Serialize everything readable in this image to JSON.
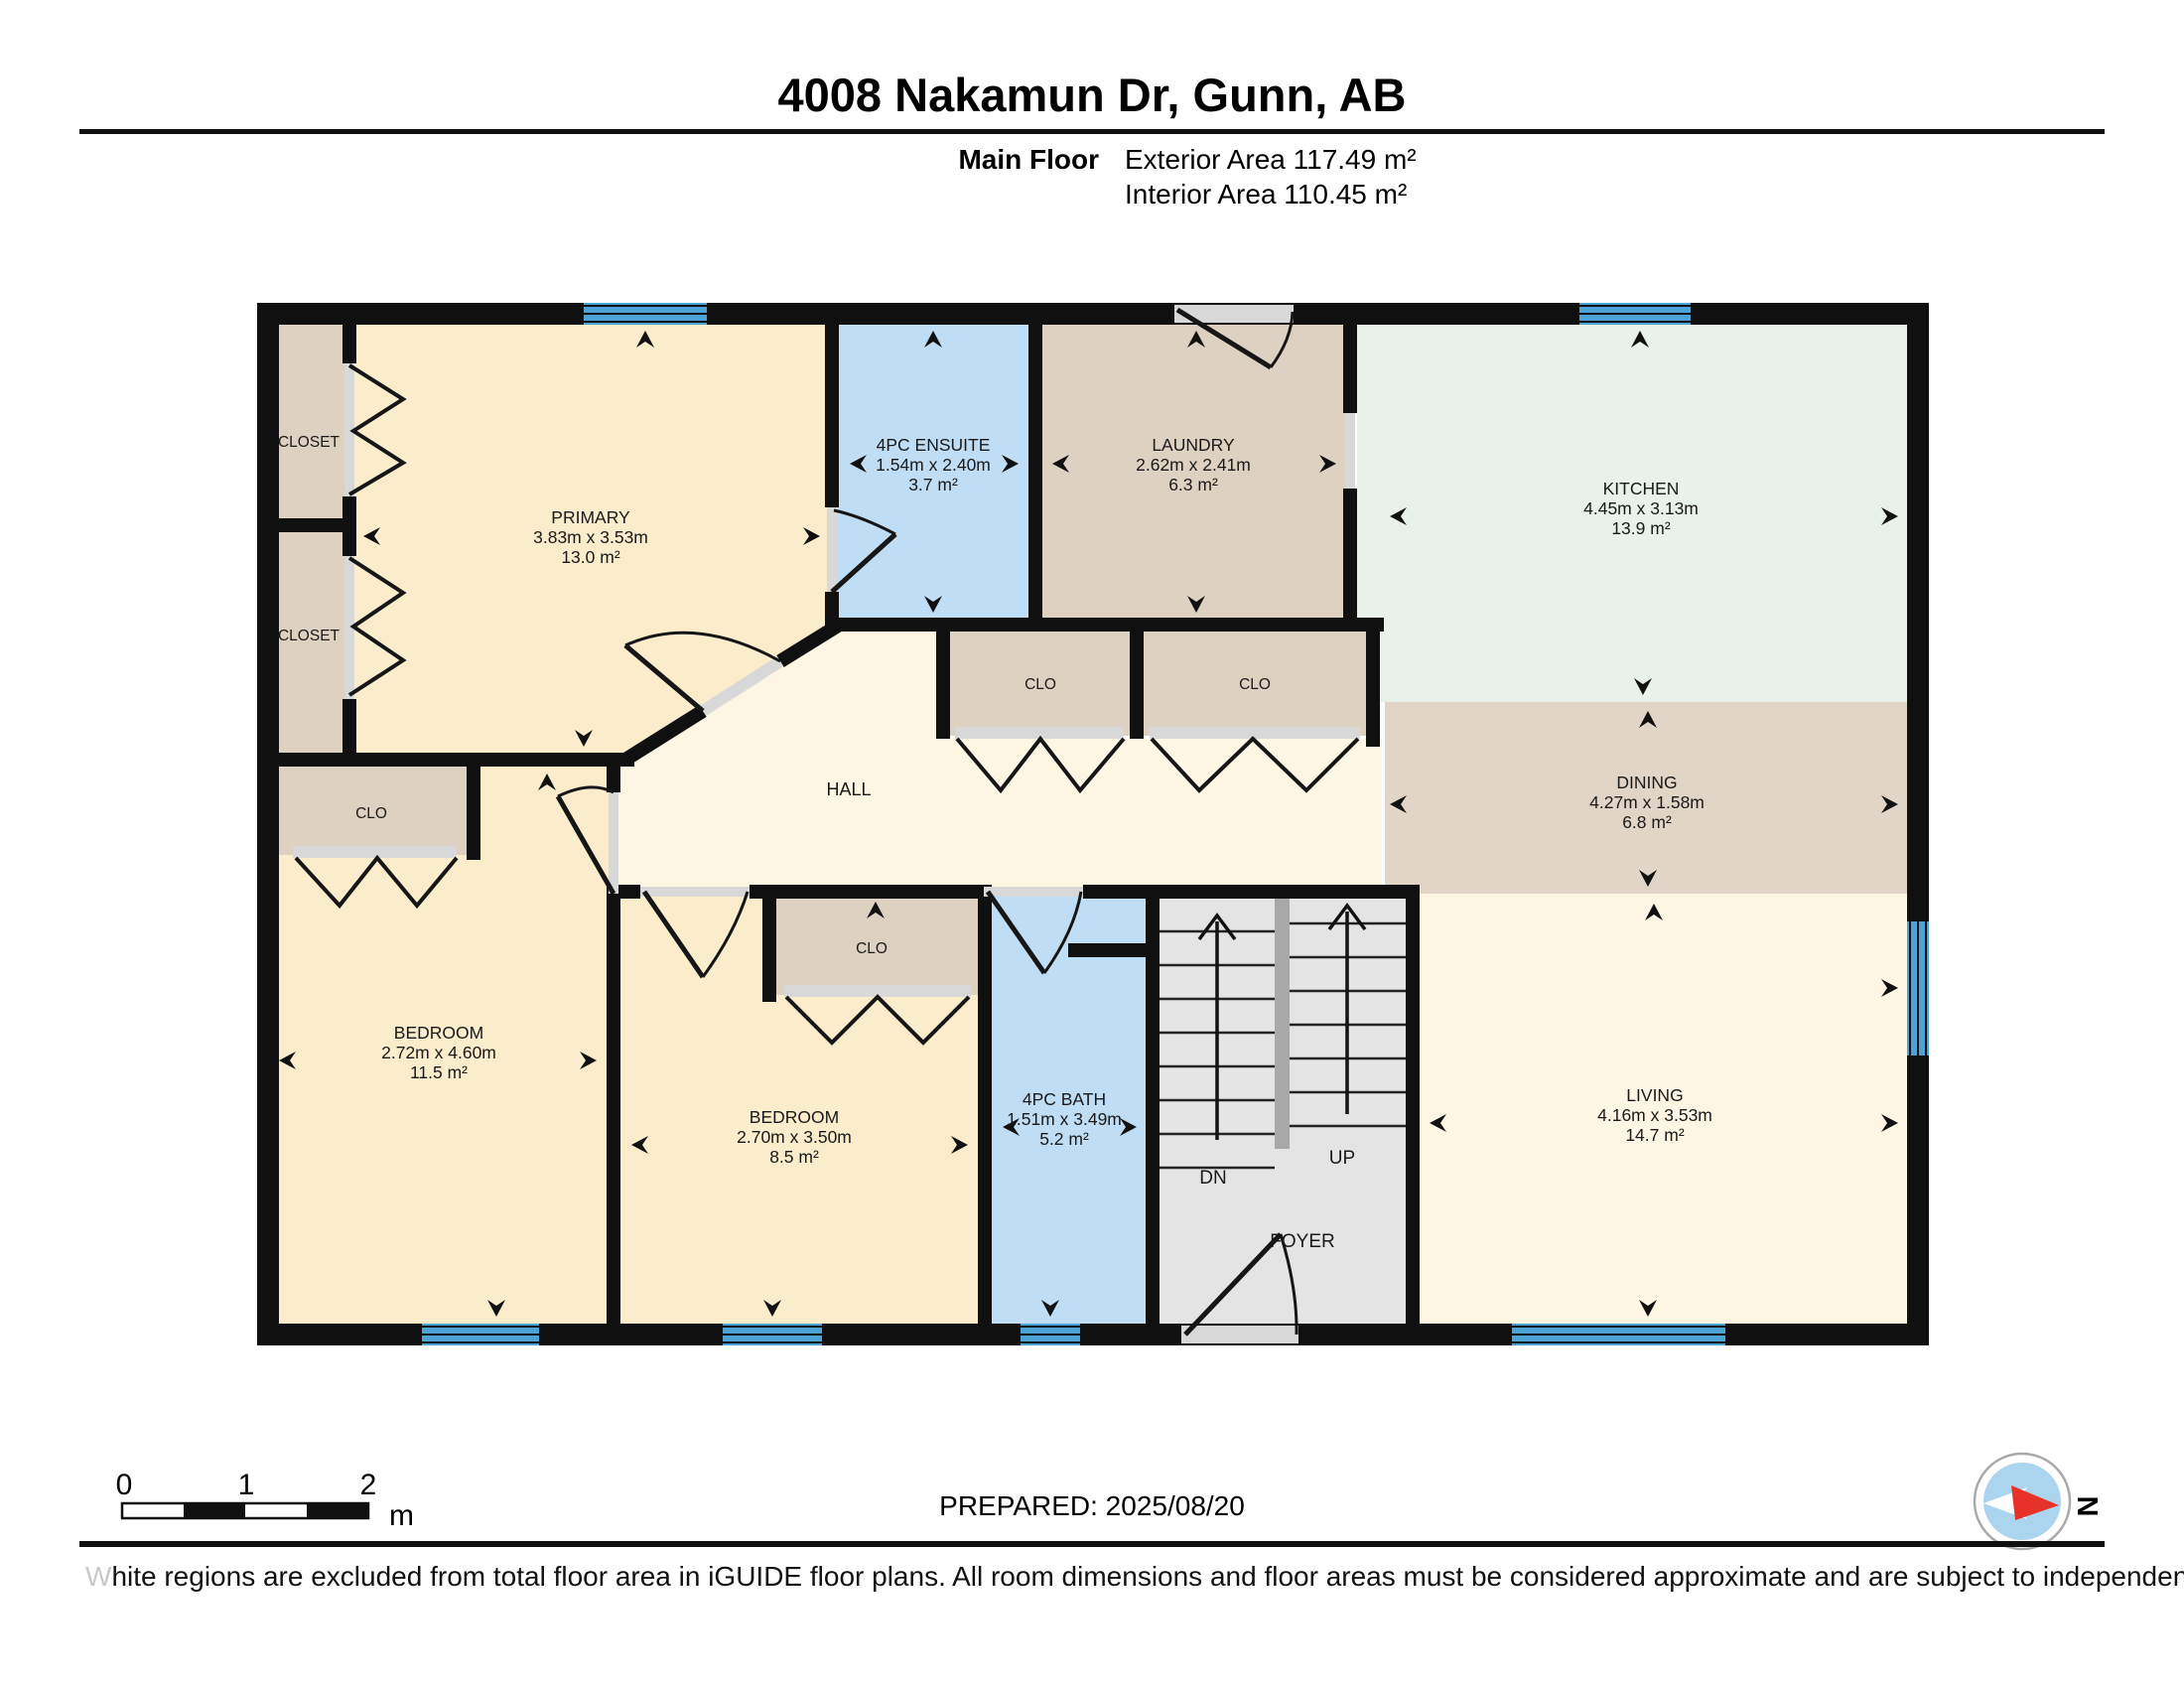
{
  "page": {
    "title": "4008 Nakamun Dr, Gunn, AB",
    "floor_label": "Main Floor",
    "exterior_area": "Exterior Area 117.49 m²",
    "interior_area": "Interior Area 110.45 m²",
    "prepared": "PREPARED: 2025/08/20",
    "disclaimer": "White regions are excluded from total floor area in iGUIDE floor plans. All room dimensions and floor areas must be considered approximate and are subject to independent verification.",
    "compass_label": "N"
  },
  "scale_bar": {
    "ticks": [
      "0",
      "1",
      "2"
    ],
    "unit": "m"
  },
  "rooms": {
    "primary": {
      "name": "PRIMARY",
      "dims": "3.83m x 3.53m",
      "area": "13.0 m²"
    },
    "ensuite": {
      "name": "4PC ENSUITE",
      "dims": "1.54m x 2.40m",
      "area": "3.7 m²"
    },
    "laundry": {
      "name": "LAUNDRY",
      "dims": "2.62m x 2.41m",
      "area": "6.3 m²"
    },
    "kitchen": {
      "name": "KITCHEN",
      "dims": "4.45m x 3.13m",
      "area": "13.9 m²"
    },
    "dining": {
      "name": "DINING",
      "dims": "4.27m x 1.58m",
      "area": "6.8 m²"
    },
    "living": {
      "name": "LIVING",
      "dims": "4.16m x 3.53m",
      "area": "14.7 m²"
    },
    "bedroom1": {
      "name": "BEDROOM",
      "dims": "2.72m x 4.60m",
      "area": "11.5 m²"
    },
    "bedroom2": {
      "name": "BEDROOM",
      "dims": "2.70m x 3.50m",
      "area": "8.5 m²"
    },
    "bath": {
      "name": "4PC BATH",
      "dims": "1.51m x 3.49m",
      "area": "5.2 m²"
    },
    "hall": {
      "name": "HALL"
    },
    "foyer": {
      "name": "FOYER"
    },
    "stairs": {
      "down": "DN",
      "up": "UP"
    },
    "closet_top": {
      "name": "CLOSET"
    },
    "closet_bottom": {
      "name": "CLOSET"
    },
    "clo_bed1": {
      "name": "CLO"
    },
    "clo_hall_left": {
      "name": "CLO"
    },
    "clo_hall_right": {
      "name": "CLO"
    },
    "clo_bed2": {
      "name": "CLO"
    }
  },
  "colors": {
    "wall": "#101010",
    "cream": "#fbeccb",
    "cream-light": "#fdf6e2",
    "blue-room": "#bfdef5",
    "tan": "#ddd2c2",
    "dining-tan": "#e0d5c6",
    "mint": "#e8f1ea",
    "stair-gray": "#e4e4e4",
    "divider-gray": "#a8a8a8",
    "opening-gray": "#d8d8d8",
    "window-blue": "#4da3d6",
    "compass-blue": "#abd4ee",
    "needle-red": "#e63229"
  }
}
